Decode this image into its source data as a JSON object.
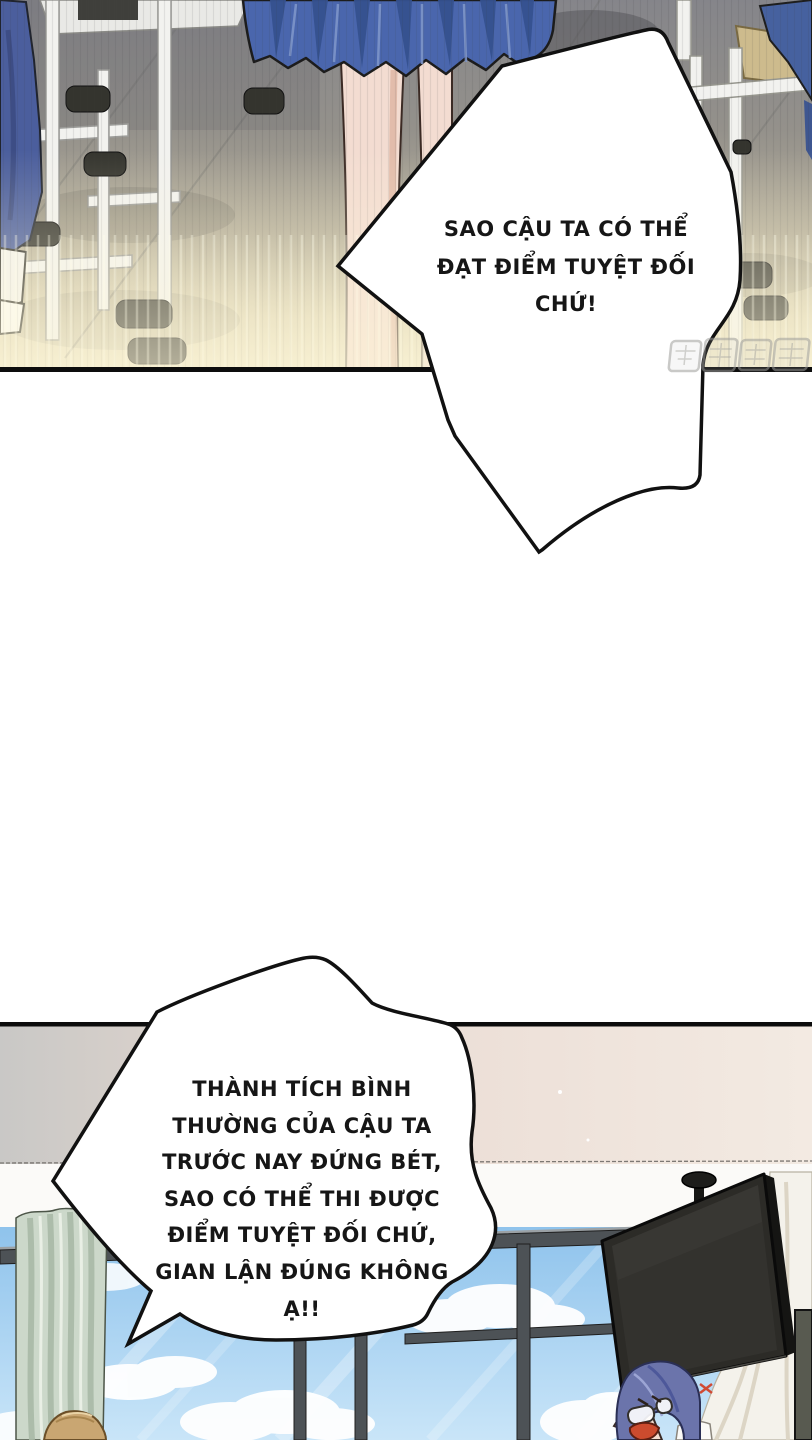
{
  "bubbles": {
    "top": {
      "lines": [
        "SAO CẬU TA CÓ THỂ",
        "ĐẠT ĐIỂM TUYỆT ĐỐI",
        "CHỨ!"
      ],
      "full_text": "SAO CẬU TA CÓ THỂ ĐẠT ĐIỂM TUYỆT ĐỐI CHỨ!"
    },
    "bottom": {
      "lines": [
        "THÀNH TÍCH BÌNH",
        "THƯỜNG CỦA CẬU TA",
        "TRƯỚC NAY ĐỨNG BÉT,",
        "SAO CÓ THỂ THI ĐƯỢC",
        "ĐIỂM TUYỆT ĐỐI CHỨ,",
        "GIAN LẬN ĐÚNG KHÔNG",
        "Ạ!!"
      ],
      "full_text": "THÀNH TÍCH BÌNH THƯỜNG CỦA CẬU TA TRƯỚC NAY ĐỨNG BÉT, SAO CÓ THỂ THI ĐƯỢC ĐIỂM TUYỆT ĐỐI CHỨ, GIAN LẬN ĐÚNG KHÔNG Ạ!!"
    }
  },
  "palette": {
    "skirt_blue": "#4a66ad",
    "pleat_shadow_blue": "#35518f",
    "uniform_pants_blue": "#4b5e9d",
    "floor_gray": "#8e8d8a",
    "floor_glow": "#efe7c9",
    "desk_tube_white": "#f2f2ef",
    "desk_top_tan": "#cdbb8d",
    "skin": "#f3dcd1",
    "sky_blue": "#8fc3ec",
    "cloud_white": "#ffffff",
    "curtain_green": "#ccd8ca",
    "curtain_white": "#f4f2eb",
    "tv_dark": "#2c2b27",
    "teacher_hair_blue": "#6b74ab",
    "student_hair_tan": "#c9a672",
    "mouth_red": "#cc4b2e",
    "outline_black": "#111111",
    "bubble_fill": "#ffffff"
  },
  "watermark": {
    "kind": "translator-logo-stamp",
    "blocks": 4
  }
}
